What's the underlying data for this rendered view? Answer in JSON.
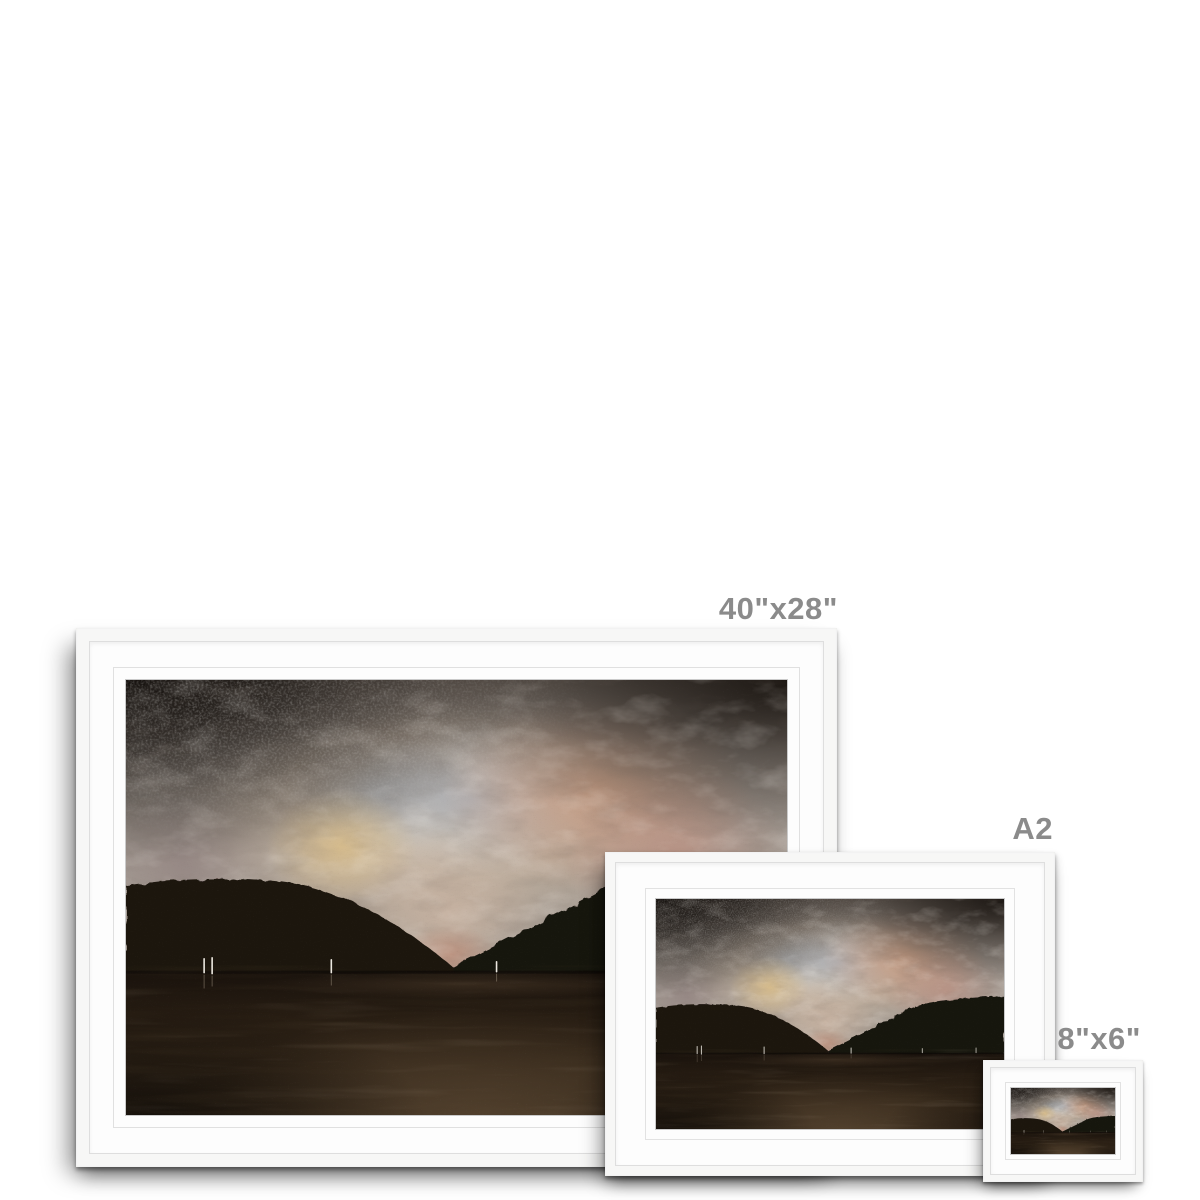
{
  "frames": [
    {
      "size_label": "40\"x28\""
    },
    {
      "size_label": "A2"
    },
    {
      "size_label": "8\"x6\""
    }
  ],
  "artwork": {
    "description": "Moody textured loch landscape at dusk: mottled pink, peach, grey and pale blue sky glowing above a central glen, dark brown hills on both sides, dark water with tiny white sail masts along the shoreline",
    "colors": {
      "sky_glow": "#e3d4c0",
      "sky_pink": "#c49a8a",
      "sky_peach": "#cf9f83",
      "sky_blue_grey": "#a6adb8",
      "sky_dark_corner": "#14100d",
      "hills": "#1c1510",
      "water_dark": "#19120c",
      "water_sheen": "#64503a",
      "sails": "#ece8e0",
      "frame": "#f7f7f6",
      "mat": "#fdfdfd",
      "label_text": "#8b8b8b"
    }
  }
}
